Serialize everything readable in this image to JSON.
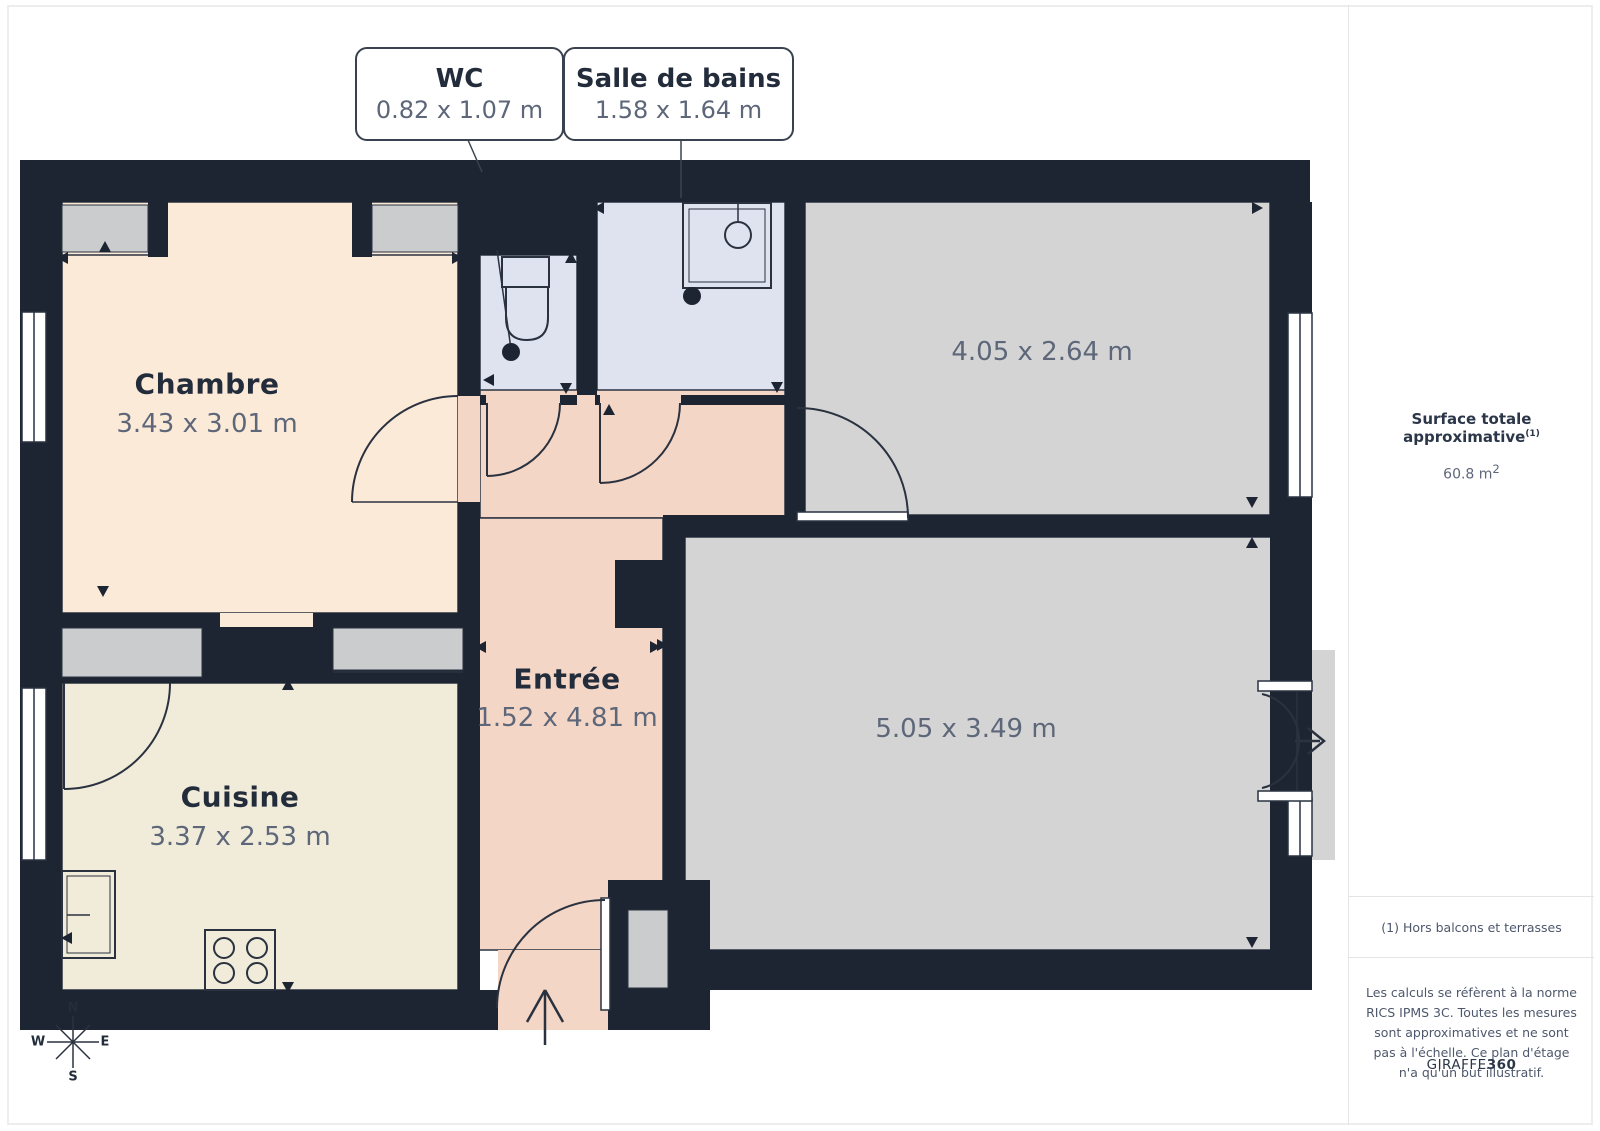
{
  "callouts": [
    {
      "title": "WC",
      "dims": "0.82 x 1.07 m"
    },
    {
      "title": "Salle de bains",
      "dims": "1.58 x 1.64 m"
    }
  ],
  "rooms": {
    "chambre": {
      "name": "Chambre",
      "dims": "3.43 x 3.01 m"
    },
    "cuisine": {
      "name": "Cuisine",
      "dims": "3.37 x 2.53 m"
    },
    "entree": {
      "name": "Entrée",
      "dims": "1.52 x 4.81 m"
    },
    "room_top_right": {
      "dims": "4.05 x 2.64 m"
    },
    "room_bottom_right": {
      "dims": "5.05 x 3.49 m"
    }
  },
  "compass": {
    "north": "N",
    "south": "S",
    "east": "E",
    "west": "W"
  },
  "sidebar": {
    "surface_label": "Surface totale approximative",
    "surface_sup": "(1)",
    "surface_value": "60.8 m",
    "surface_value_sup": "2",
    "footnote": "(1) Hors balcons et terrasses",
    "disclaimer": "Les calculs se réfèrent à la norme RICS IPMS 3C. Toutes les mesures sont approximatives et ne sont pas à l'échelle. Ce plan d'étage n'a qu'un but illustratif.",
    "brand": "GIRAFFE",
    "brand_bold": "360"
  },
  "colors": {
    "wall": "#1e2532",
    "chambre_fill": "#fcead9",
    "cuisine_fill": "#f1ecda",
    "entree_fill": "#f4d6c6",
    "bath_fill": "#dfe3ef",
    "gray_room_fill": "#d4d4d5",
    "closet_fill": "#cbccce",
    "line": "#2a3240",
    "text_dark": "#232c3b",
    "text_gray": "#5d6779"
  }
}
